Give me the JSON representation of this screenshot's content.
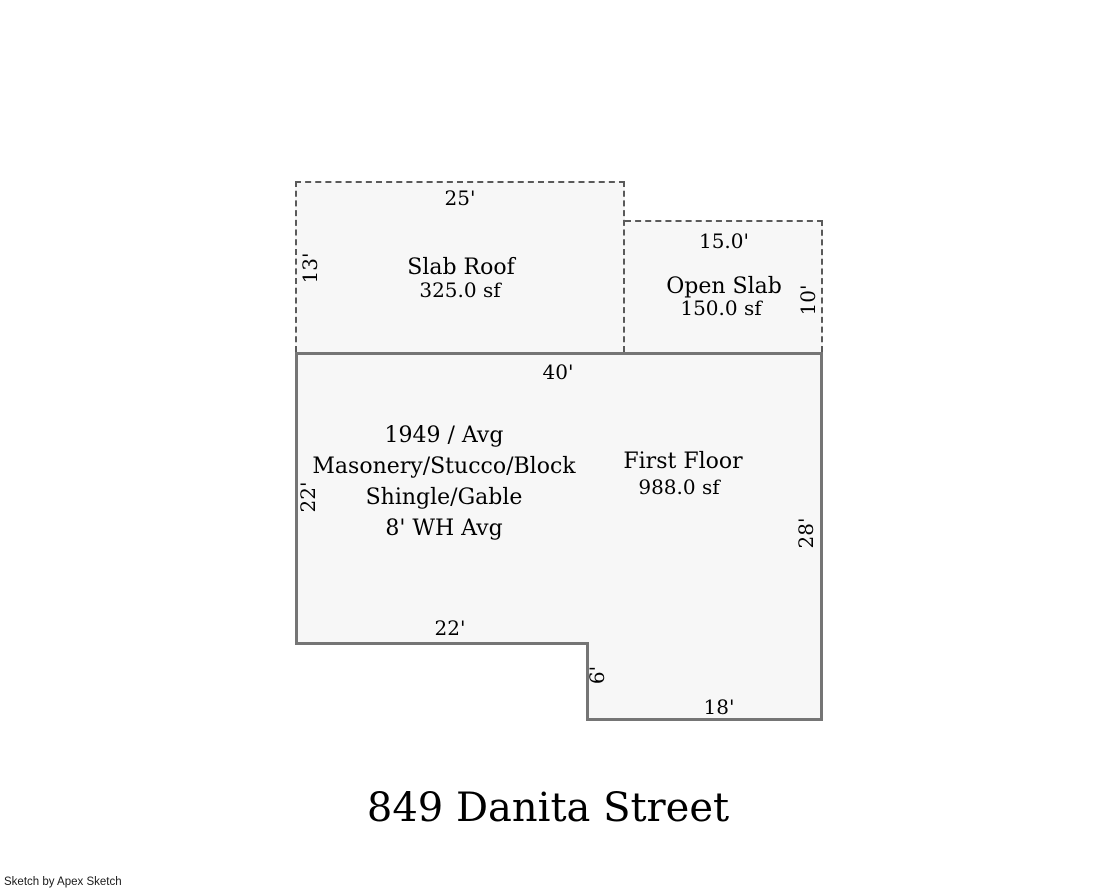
{
  "title": "849 Danita Street",
  "credit": "Sketch by Apex Sketch",
  "colors": {
    "wall": "#757575",
    "dash": "#5a5a5a",
    "fill": "#f7f7f7"
  },
  "areas": {
    "slab_roof": {
      "name": "Slab Roof",
      "area": "325.0 sf",
      "width_label": "25'",
      "height_label": "13'"
    },
    "open_slab": {
      "name": "Open Slab",
      "area": "150.0 sf",
      "width_label": "15.0'",
      "height_label": "10'"
    },
    "first_floor": {
      "name": "First Floor",
      "area": "988.0 sf",
      "top_label": "40'",
      "left_label": "22'",
      "right_label": "28'",
      "bottom_left_label": "22'",
      "notch_label": "6'",
      "bottom_right_label": "18'",
      "attributes": [
        "1949 / Avg",
        "Masonery/Stucco/Block",
        "Shingle/Gable",
        "8' WH Avg"
      ]
    }
  }
}
